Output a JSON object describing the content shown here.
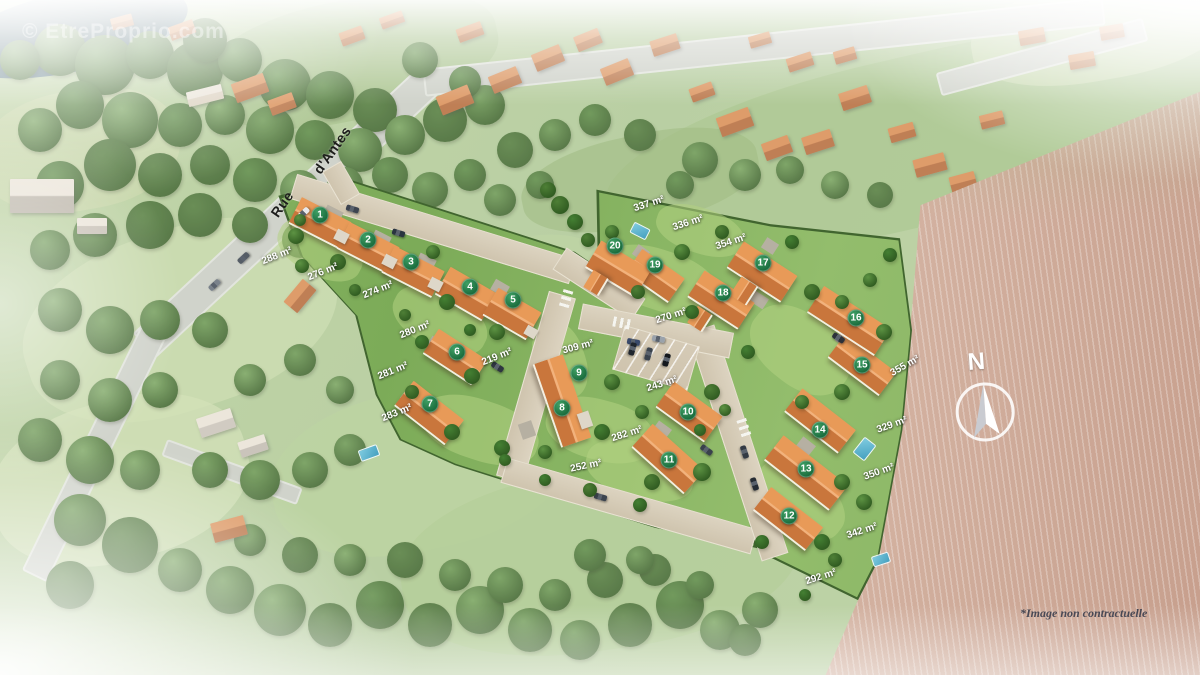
{
  "watermark": "© EtreProprio.com",
  "street": {
    "line1": "Rue",
    "line2": "d'Antes"
  },
  "north": {
    "label": "N"
  },
  "disclaimer": "*Image non contractuelle",
  "colors": {
    "marker_green": "#1f7a41",
    "roof_orange": "#d97f45",
    "road_beige": "#d2c7b2",
    "grass_green": "#8ab264",
    "hedge_green": "#41652f",
    "field_pink": "#cfa893"
  },
  "lots": [
    {
      "number": "1",
      "area": "288 m²",
      "marker": {
        "x": 320,
        "y": 215
      },
      "label": {
        "x": 277,
        "y": 256,
        "rot": -22
      }
    },
    {
      "number": "2",
      "area": "276 m²",
      "marker": {
        "x": 368,
        "y": 240
      },
      "label": {
        "x": 323,
        "y": 272,
        "rot": -22
      }
    },
    {
      "number": "3",
      "area": "274 m²",
      "marker": {
        "x": 411,
        "y": 262
      },
      "label": {
        "x": 378,
        "y": 290,
        "rot": -22
      }
    },
    {
      "number": "4",
      "area": "280 m²",
      "marker": {
        "x": 470,
        "y": 287
      },
      "label": {
        "x": 415,
        "y": 330,
        "rot": -22
      }
    },
    {
      "number": "5",
      "area": "219 m²",
      "marker": {
        "x": 513,
        "y": 300
      },
      "label": {
        "x": 497,
        "y": 357,
        "rot": -22
      }
    },
    {
      "number": "6",
      "area": "281 m²",
      "marker": {
        "x": 457,
        "y": 352
      },
      "label": {
        "x": 393,
        "y": 371,
        "rot": -22
      }
    },
    {
      "number": "7",
      "area": "283 m²",
      "marker": {
        "x": 430,
        "y": 404
      },
      "label": {
        "x": 397,
        "y": 413,
        "rot": -22
      }
    },
    {
      "number": "8",
      "area": "252 m²",
      "marker": {
        "x": 562,
        "y": 408
      },
      "label": {
        "x": 586,
        "y": 466,
        "rot": -12
      }
    },
    {
      "number": "9",
      "area": "309 m²",
      "marker": {
        "x": 579,
        "y": 373
      },
      "label": {
        "x": 578,
        "y": 347,
        "rot": -15
      }
    },
    {
      "number": "10",
      "area": "243 m²",
      "marker": {
        "x": 688,
        "y": 412
      },
      "label": {
        "x": 662,
        "y": 384,
        "rot": -18
      }
    },
    {
      "number": "11",
      "area": "282 m²",
      "marker": {
        "x": 669,
        "y": 460
      },
      "label": {
        "x": 627,
        "y": 434,
        "rot": -18
      }
    },
    {
      "number": "12",
      "area": "292 m²",
      "marker": {
        "x": 789,
        "y": 516
      },
      "label": {
        "x": 821,
        "y": 577,
        "rot": -18
      }
    },
    {
      "number": "13",
      "area": "342 m²",
      "marker": {
        "x": 806,
        "y": 469
      },
      "label": {
        "x": 862,
        "y": 531,
        "rot": -18
      }
    },
    {
      "number": "14",
      "area": "350 m²",
      "marker": {
        "x": 820,
        "y": 430
      },
      "label": {
        "x": 879,
        "y": 472,
        "rot": -20
      }
    },
    {
      "number": "15",
      "area": "329 m²",
      "marker": {
        "x": 862,
        "y": 365
      },
      "label": {
        "x": 892,
        "y": 425,
        "rot": -20
      }
    },
    {
      "number": "16",
      "area": "355 m²",
      "marker": {
        "x": 856,
        "y": 318
      },
      "label": {
        "x": 905,
        "y": 366,
        "rot": -30
      }
    },
    {
      "number": "17",
      "area": "354 m²",
      "marker": {
        "x": 763,
        "y": 263
      },
      "label": {
        "x": 731,
        "y": 242,
        "rot": -18
      }
    },
    {
      "number": "18",
      "area": "270 m²",
      "marker": {
        "x": 723,
        "y": 293
      },
      "label": {
        "x": 671,
        "y": 316,
        "rot": -18
      }
    },
    {
      "number": "19",
      "area": "336 m²",
      "marker": {
        "x": 655,
        "y": 265
      },
      "label": {
        "x": 688,
        "y": 223,
        "rot": -18
      }
    },
    {
      "number": "20",
      "area": "337 m²",
      "marker": {
        "x": 615,
        "y": 246
      },
      "label": {
        "x": 649,
        "y": 204,
        "rot": -18
      }
    }
  ]
}
